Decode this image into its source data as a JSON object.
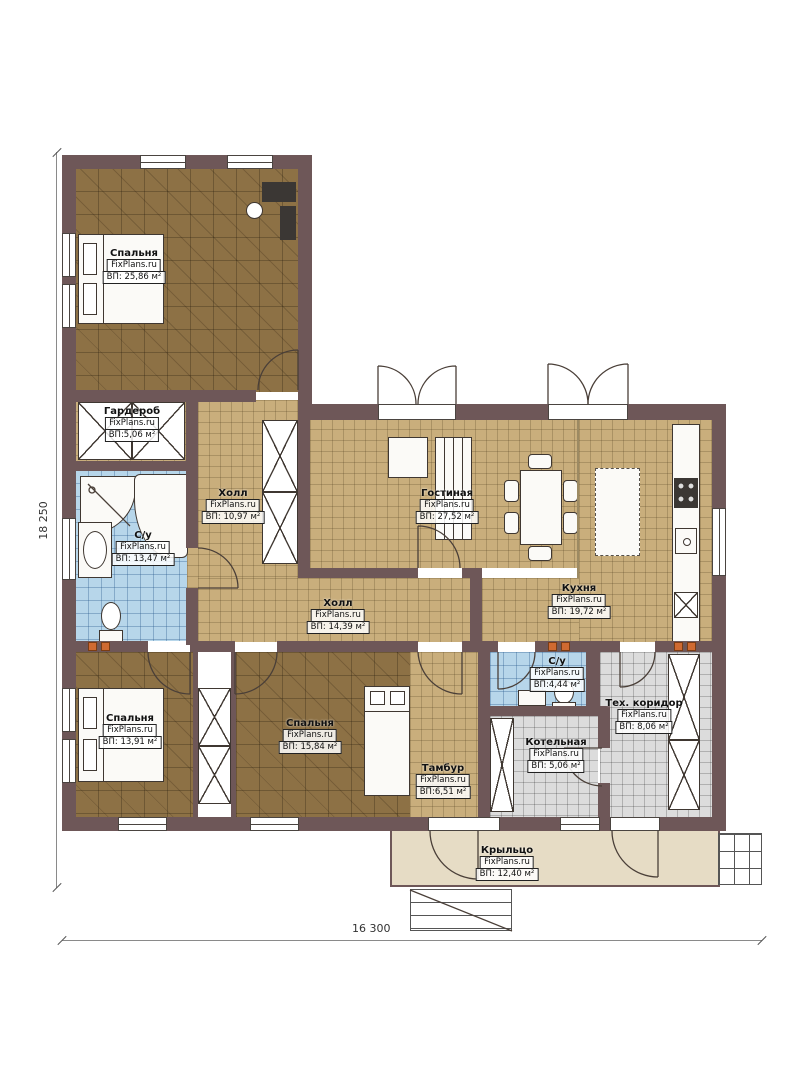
{
  "plan": {
    "brand": "FixPlans.ru",
    "dimensions": {
      "left": "18 250",
      "bottom": "16 300"
    },
    "colors": {
      "wall": "#6e5758",
      "floor_tan": "#c9ae7c",
      "floor_brown": "#8d7145",
      "floor_blue": "#b7d6ea",
      "floor_gray": "#dcdcdc",
      "porch": "#e6dcc5",
      "vent": "#cf6a31"
    }
  },
  "rooms": [
    {
      "name": "Спальня",
      "brand": "FixPlans.ru",
      "area": "ВП: 25,86 м²"
    },
    {
      "name": "Гардероб",
      "brand": "FixPlans.ru",
      "area": "ВП:5,06 м²"
    },
    {
      "name": "Холл",
      "brand": "FixPlans.ru",
      "area": "ВП: 10,97 м²"
    },
    {
      "name": "С/у",
      "brand": "FixPlans.ru",
      "area": "ВП: 13,47 м²"
    },
    {
      "name": "Гостиная",
      "brand": "FixPlans.ru",
      "area": "ВП: 27,52 м²"
    },
    {
      "name": "Кухня",
      "brand": "FixPlans.ru",
      "area": "ВП: 19,72 м²"
    },
    {
      "name": "Холл",
      "brand": "FixPlans.ru",
      "area": "ВП: 14,39 м²"
    },
    {
      "name": "Спальня",
      "brand": "FixPlans.ru",
      "area": "ВП: 13,91 м²"
    },
    {
      "name": "Спальня",
      "brand": "FixPlans.ru",
      "area": "ВП: 15,84 м²"
    },
    {
      "name": "Тамбур",
      "brand": "FixPlans.ru",
      "area": "ВП:6,51 м²"
    },
    {
      "name": "С/у",
      "brand": "FixPlans.ru",
      "area": "ВП:4,44 м²"
    },
    {
      "name": "Котельная",
      "brand": "FixPlans.ru",
      "area": "ВП: 5,06 м²"
    },
    {
      "name": "Тех. коридор",
      "brand": "FixPlans.ru",
      "area": "ВП: 8,06 м²"
    },
    {
      "name": "Крыльцо",
      "brand": "FixPlans.ru",
      "area": "ВП: 12,40 м²"
    }
  ]
}
